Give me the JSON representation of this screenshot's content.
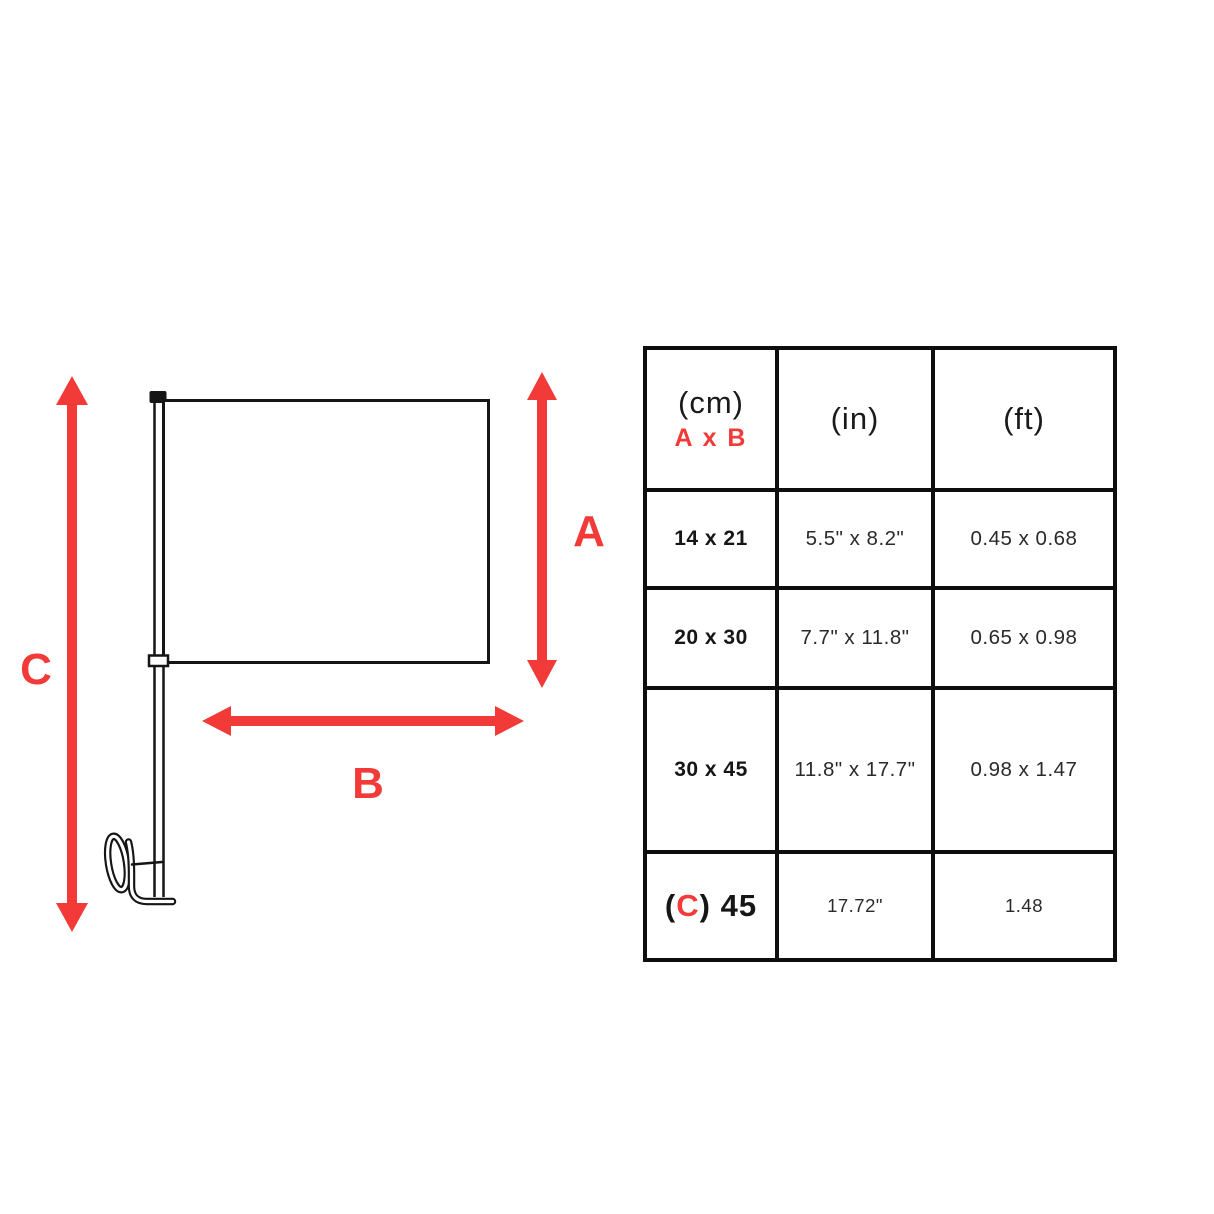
{
  "diagram": {
    "labels": {
      "a": "A",
      "b": "B",
      "c": "C"
    },
    "colors": {
      "arrow_red": "#f23b38",
      "line_black": "#151515"
    }
  },
  "table": {
    "header": {
      "unit_cm": "(cm)",
      "axb": "A x B",
      "unit_in": "(in)",
      "unit_ft": "(ft)"
    },
    "rows": [
      {
        "cm": "14 x 21",
        "inch": "5.5\" x 8.2\"",
        "ft": "0.45 x 0.68"
      },
      {
        "cm": "20 x 30",
        "inch": "7.7\" x 11.8\"",
        "ft": "0.65 x 0.98"
      },
      {
        "cm": "30 x 45",
        "inch": "11.8\" x 17.7\"",
        "ft": "0.98 x 1.47"
      }
    ],
    "last_row": {
      "open": "(",
      "letter": "C",
      "close": ") 45",
      "inch": "17.72\"",
      "ft": "1.48"
    }
  }
}
